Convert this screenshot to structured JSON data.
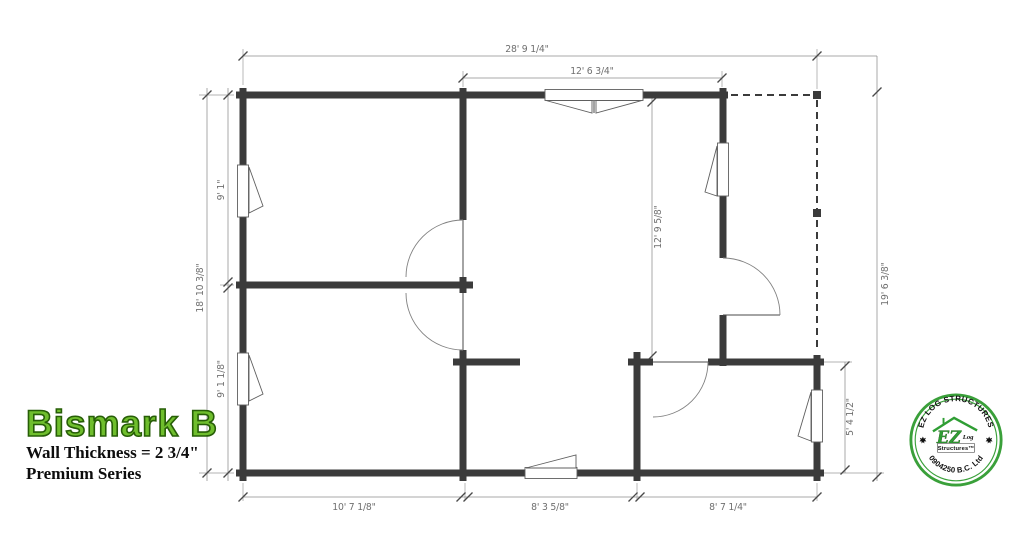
{
  "title": {
    "name": "Bismark B",
    "wall_thickness": "Wall Thickness = 2 3/4\"",
    "series": "Premium Series"
  },
  "dimensions": {
    "top_overall": "28' 9 1/4\"",
    "top_inner": "12' 6 3/4\"",
    "left_overall": "18' 10 3/8\"",
    "left_upper": "9' 1\"",
    "left_lower": "9' 1 1/8\"",
    "right_overall": "19' 6 3/8\"",
    "right_room": "5' 4 1/2\"",
    "interior_vertical": "12' 9 5/8\"",
    "bottom_left": "10' 7 1/8\"",
    "bottom_middle": "8' 3 5/8\"",
    "bottom_right": "8' 7 1/4\""
  },
  "logo": {
    "arc_top": "EZ LOG STRUCTURES",
    "arc_bottom": "0904250 B.C. Ltd",
    "emblem_ez": "EZ",
    "emblem_log": "Log",
    "emblem_structures": "Structures™"
  },
  "colors": {
    "wall": "#3b3b3b",
    "dimension": "#6f6f6f",
    "title_green": "#6fbe2d",
    "title_outline": "#275e07",
    "logo_green": "#3aa03a"
  }
}
